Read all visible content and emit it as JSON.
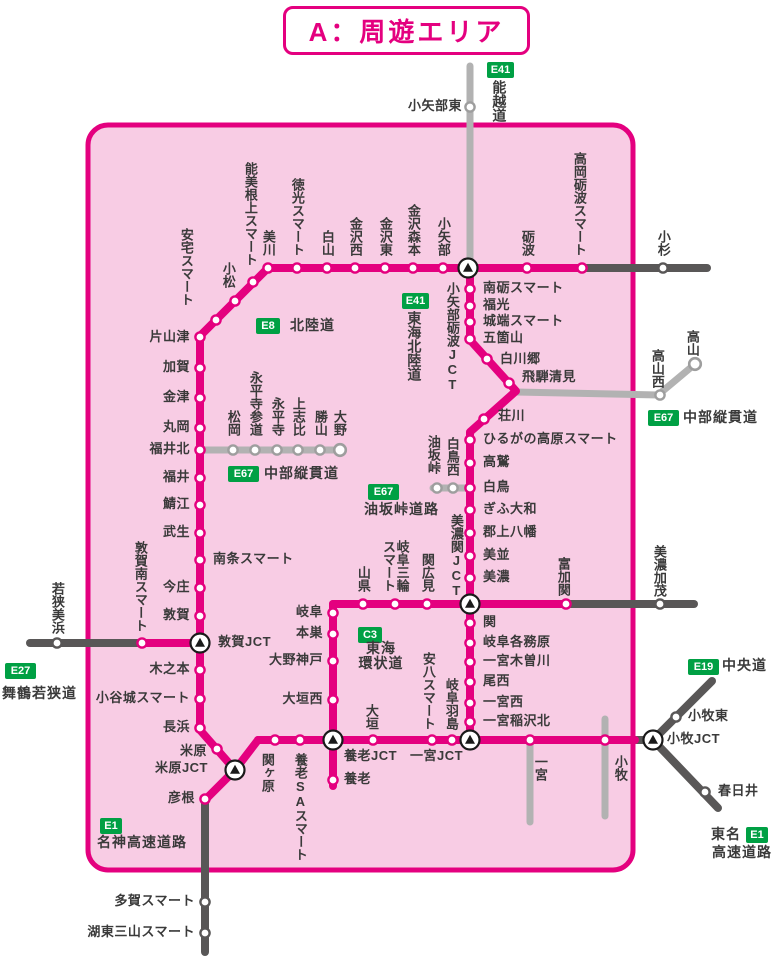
{
  "title": {
    "text": "A：周遊エリア"
  },
  "colors": {
    "pink_line": "#e4007f",
    "area_fill": "#f8cce4",
    "dark_gray_line": "#595757",
    "light_gray_line": "#b2b2b2",
    "badge_green": "#00a044",
    "text": "#3a3a3a"
  },
  "jcts": [
    {
      "name": "小矢部砺波JCT",
      "x": 468,
      "y": 268,
      "label": {
        "x": 452,
        "y": 282,
        "o": "v",
        "a": "t"
      }
    },
    {
      "name": "美濃関JCT",
      "x": 470,
      "y": 604,
      "label": {
        "x": 456,
        "y": 598,
        "o": "v",
        "a": "b"
      }
    },
    {
      "name": "敦賀JCT",
      "x": 200,
      "y": 643,
      "label": {
        "x": 218,
        "y": 643,
        "o": "h",
        "a": "l"
      }
    },
    {
      "name": "米原JCT",
      "x": 235,
      "y": 770,
      "label": {
        "x": 208,
        "y": 769,
        "o": "h",
        "a": "r"
      }
    },
    {
      "name": "養老JCT",
      "x": 333,
      "y": 740,
      "label": {
        "x": 344,
        "y": 757,
        "o": "h",
        "a": "l"
      }
    },
    {
      "name": "一宮JCT",
      "x": 470,
      "y": 740,
      "label": {
        "x": 410,
        "y": 757,
        "o": "h",
        "a": "l"
      }
    },
    {
      "name": "小牧JCT",
      "x": 653,
      "y": 740,
      "label": {
        "x": 667,
        "y": 740,
        "o": "h",
        "a": "l"
      }
    }
  ],
  "stations": [
    {
      "name": "美川",
      "x": 268,
      "y": 268,
      "ring": "pink",
      "label": {
        "x": 268,
        "y": 256,
        "o": "v",
        "a": "b"
      }
    },
    {
      "name": "徳光スマート",
      "x": 297,
      "y": 268,
      "ring": "pink",
      "label": {
        "x": 297,
        "y": 256,
        "o": "v",
        "a": "b"
      }
    },
    {
      "name": "白山",
      "x": 327,
      "y": 268,
      "ring": "pink",
      "label": {
        "x": 327,
        "y": 256,
        "o": "v",
        "a": "b"
      }
    },
    {
      "name": "金沢西",
      "x": 355,
      "y": 268,
      "ring": "pink",
      "label": {
        "x": 355,
        "y": 256,
        "o": "v",
        "a": "b"
      }
    },
    {
      "name": "金沢東",
      "x": 385,
      "y": 268,
      "ring": "pink",
      "label": {
        "x": 385,
        "y": 256,
        "o": "v",
        "a": "b"
      }
    },
    {
      "name": "金沢森本",
      "x": 413,
      "y": 268,
      "ring": "pink",
      "label": {
        "x": 413,
        "y": 256,
        "o": "v",
        "a": "b"
      }
    },
    {
      "name": "小矢部",
      "x": 443,
      "y": 268,
      "ring": "pink",
      "label": {
        "x": 443,
        "y": 256,
        "o": "v",
        "a": "b"
      }
    },
    {
      "name": "砺波",
      "x": 527,
      "y": 268,
      "ring": "pink",
      "label": {
        "x": 527,
        "y": 256,
        "o": "v",
        "a": "b"
      }
    },
    {
      "name": "高岡砺波スマート",
      "x": 582,
      "y": 268,
      "ring": "pink",
      "label": {
        "x": 579,
        "y": 256,
        "o": "v",
        "a": "b"
      }
    },
    {
      "name": "能美根上スマート",
      "x": 253,
      "y": 282,
      "ring": "pink",
      "label": {
        "x": 250,
        "y": 266,
        "o": "v",
        "a": "b"
      }
    },
    {
      "name": "安宅スマート",
      "x": 235,
      "y": 301,
      "ring": "pink",
      "label": {
        "x": 186,
        "y": 306,
        "o": "v",
        "a": "b"
      }
    },
    {
      "name": "小松",
      "x": 216,
      "y": 320,
      "ring": "pink",
      "label": {
        "x": 228,
        "y": 288,
        "o": "v",
        "a": "b"
      }
    },
    {
      "name": "片山津",
      "x": 200,
      "y": 337,
      "ring": "pink",
      "label": {
        "x": 190,
        "y": 338,
        "o": "h",
        "a": "r"
      }
    },
    {
      "name": "加賀",
      "x": 200,
      "y": 368,
      "ring": "pink",
      "label": {
        "x": 190,
        "y": 368,
        "o": "h",
        "a": "r"
      }
    },
    {
      "name": "金津",
      "x": 200,
      "y": 398,
      "ring": "pink",
      "label": {
        "x": 190,
        "y": 398,
        "o": "h",
        "a": "r"
      }
    },
    {
      "name": "丸岡",
      "x": 200,
      "y": 428,
      "ring": "pink",
      "label": {
        "x": 190,
        "y": 428,
        "o": "h",
        "a": "r"
      }
    },
    {
      "name": "福井北",
      "x": 200,
      "y": 450,
      "ring": "pink",
      "label": {
        "x": 190,
        "y": 450,
        "o": "h",
        "a": "r"
      }
    },
    {
      "name": "福井",
      "x": 200,
      "y": 478,
      "ring": "pink",
      "label": {
        "x": 190,
        "y": 478,
        "o": "h",
        "a": "r"
      }
    },
    {
      "name": "鯖江",
      "x": 200,
      "y": 505,
      "ring": "pink",
      "label": {
        "x": 190,
        "y": 505,
        "o": "h",
        "a": "r"
      }
    },
    {
      "name": "武生",
      "x": 200,
      "y": 533,
      "ring": "pink",
      "label": {
        "x": 190,
        "y": 533,
        "o": "h",
        "a": "r"
      }
    },
    {
      "name": "南条スマート",
      "x": 200,
      "y": 560,
      "ring": "pink",
      "label": {
        "x": 213,
        "y": 560,
        "o": "h",
        "a": "l"
      }
    },
    {
      "name": "今庄",
      "x": 200,
      "y": 588,
      "ring": "pink",
      "label": {
        "x": 190,
        "y": 588,
        "o": "h",
        "a": "r"
      }
    },
    {
      "name": "敦賀",
      "x": 200,
      "y": 616,
      "ring": "pink",
      "label": {
        "x": 190,
        "y": 616,
        "o": "h",
        "a": "r"
      }
    },
    {
      "name": "敦賀南スマート",
      "x": 142,
      "y": 643,
      "ring": "pink",
      "label": {
        "x": 140,
        "y": 632,
        "o": "v",
        "a": "b"
      }
    },
    {
      "name": "木之本",
      "x": 200,
      "y": 670,
      "ring": "pink",
      "label": {
        "x": 190,
        "y": 670,
        "o": "h",
        "a": "r"
      }
    },
    {
      "name": "小谷城スマート",
      "x": 200,
      "y": 699,
      "ring": "pink",
      "label": {
        "x": 190,
        "y": 699,
        "o": "h",
        "a": "r"
      }
    },
    {
      "name": "長浜",
      "x": 200,
      "y": 728,
      "ring": "pink",
      "label": {
        "x": 190,
        "y": 728,
        "o": "h",
        "a": "r"
      }
    },
    {
      "name": "米原",
      "x": 217,
      "y": 749,
      "ring": "pink",
      "label": {
        "x": 207,
        "y": 752,
        "o": "h",
        "a": "r"
      }
    },
    {
      "name": "彦根",
      "x": 205,
      "y": 799,
      "ring": "pink",
      "label": {
        "x": 195,
        "y": 799,
        "o": "h",
        "a": "r"
      }
    },
    {
      "name": "南砺スマート",
      "x": 470,
      "y": 289,
      "ring": "pink",
      "label": {
        "x": 483,
        "y": 289,
        "o": "h",
        "a": "l"
      }
    },
    {
      "name": "福光",
      "x": 470,
      "y": 306,
      "ring": "pink",
      "label": {
        "x": 483,
        "y": 306,
        "o": "h",
        "a": "l"
      }
    },
    {
      "name": "城端スマート",
      "x": 470,
      "y": 322,
      "ring": "pink",
      "label": {
        "x": 483,
        "y": 322,
        "o": "h",
        "a": "l"
      }
    },
    {
      "name": "五箇山",
      "x": 470,
      "y": 339,
      "ring": "pink",
      "label": {
        "x": 483,
        "y": 339,
        "o": "h",
        "a": "l"
      }
    },
    {
      "name": "白川郷",
      "x": 487,
      "y": 359,
      "ring": "pink",
      "label": {
        "x": 500,
        "y": 360,
        "o": "h",
        "a": "l"
      }
    },
    {
      "name": "飛騨清見",
      "x": 509,
      "y": 383,
      "ring": "pink",
      "label": {
        "x": 522,
        "y": 378,
        "o": "h",
        "a": "l"
      }
    },
    {
      "name": "荘川",
      "x": 484,
      "y": 419,
      "ring": "pink",
      "label": {
        "x": 498,
        "y": 417,
        "o": "h",
        "a": "l"
      }
    },
    {
      "name": "ひるがの高原スマート",
      "x": 470,
      "y": 440,
      "ring": "pink",
      "label": {
        "x": 483,
        "y": 440,
        "o": "h",
        "a": "l"
      }
    },
    {
      "name": "高鷲",
      "x": 470,
      "y": 463,
      "ring": "pink",
      "label": {
        "x": 483,
        "y": 463,
        "o": "h",
        "a": "l"
      }
    },
    {
      "name": "白鳥",
      "x": 470,
      "y": 488,
      "ring": "pink",
      "label": {
        "x": 483,
        "y": 488,
        "o": "h",
        "a": "l"
      }
    },
    {
      "name": "ぎふ大和",
      "x": 470,
      "y": 510,
      "ring": "pink",
      "label": {
        "x": 483,
        "y": 510,
        "o": "h",
        "a": "l"
      }
    },
    {
      "name": "郡上八幡",
      "x": 470,
      "y": 533,
      "ring": "pink",
      "label": {
        "x": 483,
        "y": 533,
        "o": "h",
        "a": "l"
      }
    },
    {
      "name": "美並",
      "x": 470,
      "y": 556,
      "ring": "pink",
      "label": {
        "x": 483,
        "y": 556,
        "o": "h",
        "a": "l"
      }
    },
    {
      "name": "美濃",
      "x": 470,
      "y": 578,
      "ring": "pink",
      "label": {
        "x": 483,
        "y": 578,
        "o": "h",
        "a": "l"
      }
    },
    {
      "name": "富加関",
      "x": 566,
      "y": 604,
      "ring": "pink",
      "label": {
        "x": 563,
        "y": 596,
        "o": "v",
        "a": "b"
      }
    },
    {
      "name": "山県",
      "x": 363,
      "y": 604,
      "ring": "pink",
      "label": {
        "x": 363,
        "y": 592,
        "o": "v",
        "a": "b"
      }
    },
    {
      "name": "岐阜三輪\nスマート",
      "x": 395,
      "y": 604,
      "ring": "pink",
      "label": {
        "x": 395,
        "y": 592,
        "o": "v",
        "a": "b"
      }
    },
    {
      "name": "関広見",
      "x": 427,
      "y": 604,
      "ring": "pink",
      "label": {
        "x": 427,
        "y": 592,
        "o": "v",
        "a": "b"
      }
    },
    {
      "name": "岐阜",
      "x": 333,
      "y": 613,
      "ring": "pink",
      "label": {
        "x": 323,
        "y": 613,
        "o": "h",
        "a": "r"
      }
    },
    {
      "name": "本巣",
      "x": 333,
      "y": 634,
      "ring": "pink",
      "label": {
        "x": 323,
        "y": 634,
        "o": "h",
        "a": "r"
      }
    },
    {
      "name": "大野神戸",
      "x": 333,
      "y": 661,
      "ring": "pink",
      "label": {
        "x": 323,
        "y": 661,
        "o": "h",
        "a": "r"
      }
    },
    {
      "name": "大垣西",
      "x": 333,
      "y": 700,
      "ring": "pink",
      "label": {
        "x": 323,
        "y": 700,
        "o": "h",
        "a": "r"
      }
    },
    {
      "name": "関",
      "x": 470,
      "y": 623,
      "ring": "pink",
      "label": {
        "x": 483,
        "y": 623,
        "o": "h",
        "a": "l"
      }
    },
    {
      "name": "岐阜各務原",
      "x": 470,
      "y": 643,
      "ring": "pink",
      "label": {
        "x": 483,
        "y": 643,
        "o": "h",
        "a": "l"
      }
    },
    {
      "name": "一宮木曽川",
      "x": 470,
      "y": 662,
      "ring": "pink",
      "label": {
        "x": 483,
        "y": 662,
        "o": "h",
        "a": "l"
      }
    },
    {
      "name": "尾西",
      "x": 470,
      "y": 682,
      "ring": "pink",
      "label": {
        "x": 483,
        "y": 682,
        "o": "h",
        "a": "l"
      }
    },
    {
      "name": "一宮西",
      "x": 470,
      "y": 703,
      "ring": "pink",
      "label": {
        "x": 483,
        "y": 703,
        "o": "h",
        "a": "l"
      }
    },
    {
      "name": "一宮稲沢北",
      "x": 470,
      "y": 722,
      "ring": "pink",
      "label": {
        "x": 483,
        "y": 722,
        "o": "h",
        "a": "l"
      }
    },
    {
      "name": "関ヶ原",
      "x": 275,
      "y": 740,
      "ring": "pink",
      "label": {
        "x": 267,
        "y": 753,
        "o": "v",
        "a": "t"
      }
    },
    {
      "name": "養老SAスマート",
      "x": 300,
      "y": 740,
      "ring": "pink",
      "label": {
        "x": 300,
        "y": 753,
        "o": "v",
        "a": "t"
      }
    },
    {
      "name": "大垣",
      "x": 373,
      "y": 740,
      "ring": "pink",
      "label": {
        "x": 371,
        "y": 730,
        "o": "v",
        "a": "b"
      }
    },
    {
      "name": "安八スマート",
      "x": 432,
      "y": 740,
      "ring": "pink",
      "label": {
        "x": 428,
        "y": 730,
        "o": "v",
        "a": "b"
      }
    },
    {
      "name": "岐阜羽島",
      "x": 452,
      "y": 740,
      "ring": "pink",
      "label": {
        "x": 451,
        "y": 730,
        "o": "v",
        "a": "b"
      }
    },
    {
      "name": "一宮",
      "x": 530,
      "y": 740,
      "ring": "pink",
      "label": {
        "x": 540,
        "y": 755,
        "o": "v",
        "a": "t"
      }
    },
    {
      "name": "小牧",
      "x": 605,
      "y": 740,
      "ring": "pink",
      "label": {
        "x": 620,
        "y": 755,
        "o": "v",
        "a": "t"
      }
    },
    {
      "name": "養老",
      "x": 333,
      "y": 780,
      "ring": "pink",
      "label": {
        "x": 344,
        "y": 780,
        "o": "h",
        "a": "l"
      }
    },
    {
      "name": "小杉",
      "x": 663,
      "y": 268,
      "ring": "dark",
      "label": {
        "x": 663,
        "y": 256,
        "o": "v",
        "a": "b"
      }
    },
    {
      "name": "若狭美浜",
      "x": 57,
      "y": 643,
      "ring": "dark",
      "label": {
        "x": 57,
        "y": 634,
        "o": "v",
        "a": "b"
      }
    },
    {
      "name": "美濃加茂",
      "x": 660,
      "y": 604,
      "ring": "dark",
      "label": {
        "x": 659,
        "y": 597,
        "o": "v",
        "a": "b"
      }
    },
    {
      "name": "多賀スマート",
      "x": 205,
      "y": 902,
      "ring": "dark",
      "label": {
        "x": 195,
        "y": 902,
        "o": "h",
        "a": "r"
      }
    },
    {
      "name": "湖東三山スマート",
      "x": 205,
      "y": 933,
      "ring": "dark",
      "label": {
        "x": 195,
        "y": 933,
        "o": "h",
        "a": "r"
      }
    },
    {
      "name": "小牧東",
      "x": 676,
      "y": 717,
      "ring": "dark",
      "label": {
        "x": 688,
        "y": 717,
        "o": "h",
        "a": "l"
      }
    },
    {
      "name": "春日井",
      "x": 705,
      "y": 792,
      "ring": "dark",
      "label": {
        "x": 718,
        "y": 792,
        "o": "h",
        "a": "l"
      }
    },
    {
      "name": "小矢部東",
      "x": 470,
      "y": 107,
      "ring": "light",
      "label": {
        "x": 462,
        "y": 107,
        "o": "h",
        "a": "r"
      }
    },
    {
      "name": "松岡",
      "x": 233,
      "y": 450,
      "ring": "light",
      "label": {
        "x": 233,
        "y": 436,
        "o": "v",
        "a": "b"
      }
    },
    {
      "name": "永平寺参道",
      "x": 255,
      "y": 450,
      "ring": "light",
      "label": {
        "x": 255,
        "y": 436,
        "o": "v",
        "a": "b"
      }
    },
    {
      "name": "永平寺",
      "x": 277,
      "y": 450,
      "ring": "light",
      "label": {
        "x": 277,
        "y": 436,
        "o": "v",
        "a": "b"
      }
    },
    {
      "name": "上志比",
      "x": 298,
      "y": 450,
      "ring": "light",
      "label": {
        "x": 298,
        "y": 436,
        "o": "v",
        "a": "b"
      }
    },
    {
      "name": "勝山",
      "x": 320,
      "y": 450,
      "ring": "light",
      "label": {
        "x": 320,
        "y": 436,
        "o": "v",
        "a": "b"
      }
    },
    {
      "name": "大野",
      "x": 340,
      "y": 450,
      "ring": "light",
      "end": true,
      "label": {
        "x": 339,
        "y": 436,
        "o": "v",
        "a": "b"
      }
    },
    {
      "name": "油坂峠",
      "x": 437,
      "y": 488,
      "ring": "light",
      "label": {
        "x": 433,
        "y": 474,
        "o": "v",
        "a": "b"
      }
    },
    {
      "name": "白鳥西",
      "x": 453,
      "y": 488,
      "ring": "light",
      "label": {
        "x": 452,
        "y": 476,
        "o": "v",
        "a": "b"
      }
    },
    {
      "name": "高山西",
      "x": 660,
      "y": 395,
      "ring": "light",
      "label": {
        "x": 657,
        "y": 388,
        "o": "v",
        "a": "b"
      }
    },
    {
      "name": "高山",
      "x": 695,
      "y": 364,
      "ring": "light",
      "end": true,
      "label": {
        "x": 692,
        "y": 356,
        "o": "v",
        "a": "b"
      }
    }
  ],
  "badges": [
    {
      "label": "E41",
      "x": 487,
      "y": 62,
      "w": 27
    },
    {
      "label": "E41",
      "x": 402,
      "y": 293,
      "w": 27
    },
    {
      "label": "E8",
      "x": 256,
      "y": 318,
      "w": 24
    },
    {
      "label": "E67",
      "x": 228,
      "y": 466,
      "w": 31
    },
    {
      "label": "E67",
      "x": 368,
      "y": 484,
      "w": 31
    },
    {
      "label": "E67",
      "x": 648,
      "y": 410,
      "w": 31
    },
    {
      "label": "C3",
      "x": 358,
      "y": 627,
      "w": 24
    },
    {
      "label": "E27",
      "x": 5,
      "y": 663,
      "w": 31
    },
    {
      "label": "E19",
      "x": 688,
      "y": 659,
      "w": 31
    },
    {
      "label": "E1",
      "x": 100,
      "y": 818,
      "w": 22
    },
    {
      "label": "E1",
      "x": 746,
      "y": 827,
      "w": 22
    }
  ],
  "road_labels": [
    {
      "text": "能越道",
      "x": 499,
      "y": 80,
      "o": "v",
      "a": "t"
    },
    {
      "text": "東海北陸道",
      "x": 414,
      "y": 311,
      "o": "v",
      "a": "t"
    },
    {
      "text": "北陸道",
      "x": 290,
      "y": 326,
      "o": "h",
      "a": "l"
    },
    {
      "text": "中部縦貫道",
      "x": 264,
      "y": 474,
      "o": "h",
      "a": "l"
    },
    {
      "text": "油坂峠道路",
      "x": 364,
      "y": 510,
      "o": "h",
      "a": "l"
    },
    {
      "text": "中部縦貫道",
      "x": 683,
      "y": 418,
      "o": "h",
      "a": "l"
    },
    {
      "text": "東海\n環状道",
      "x": 381,
      "y": 650,
      "o": "h",
      "a": "c"
    },
    {
      "text": "舞鶴若狭道",
      "x": 2,
      "y": 694,
      "o": "h",
      "a": "l"
    },
    {
      "text": "中央道",
      "x": 722,
      "y": 666,
      "o": "h",
      "a": "l"
    },
    {
      "text": "名神高速道路",
      "x": 97,
      "y": 843,
      "o": "h",
      "a": "l"
    },
    {
      "text": "東名",
      "x": 741,
      "y": 835,
      "o": "h",
      "a": "r"
    },
    {
      "text": "高速道路",
      "x": 712,
      "y": 853,
      "o": "h",
      "a": "l"
    }
  ]
}
